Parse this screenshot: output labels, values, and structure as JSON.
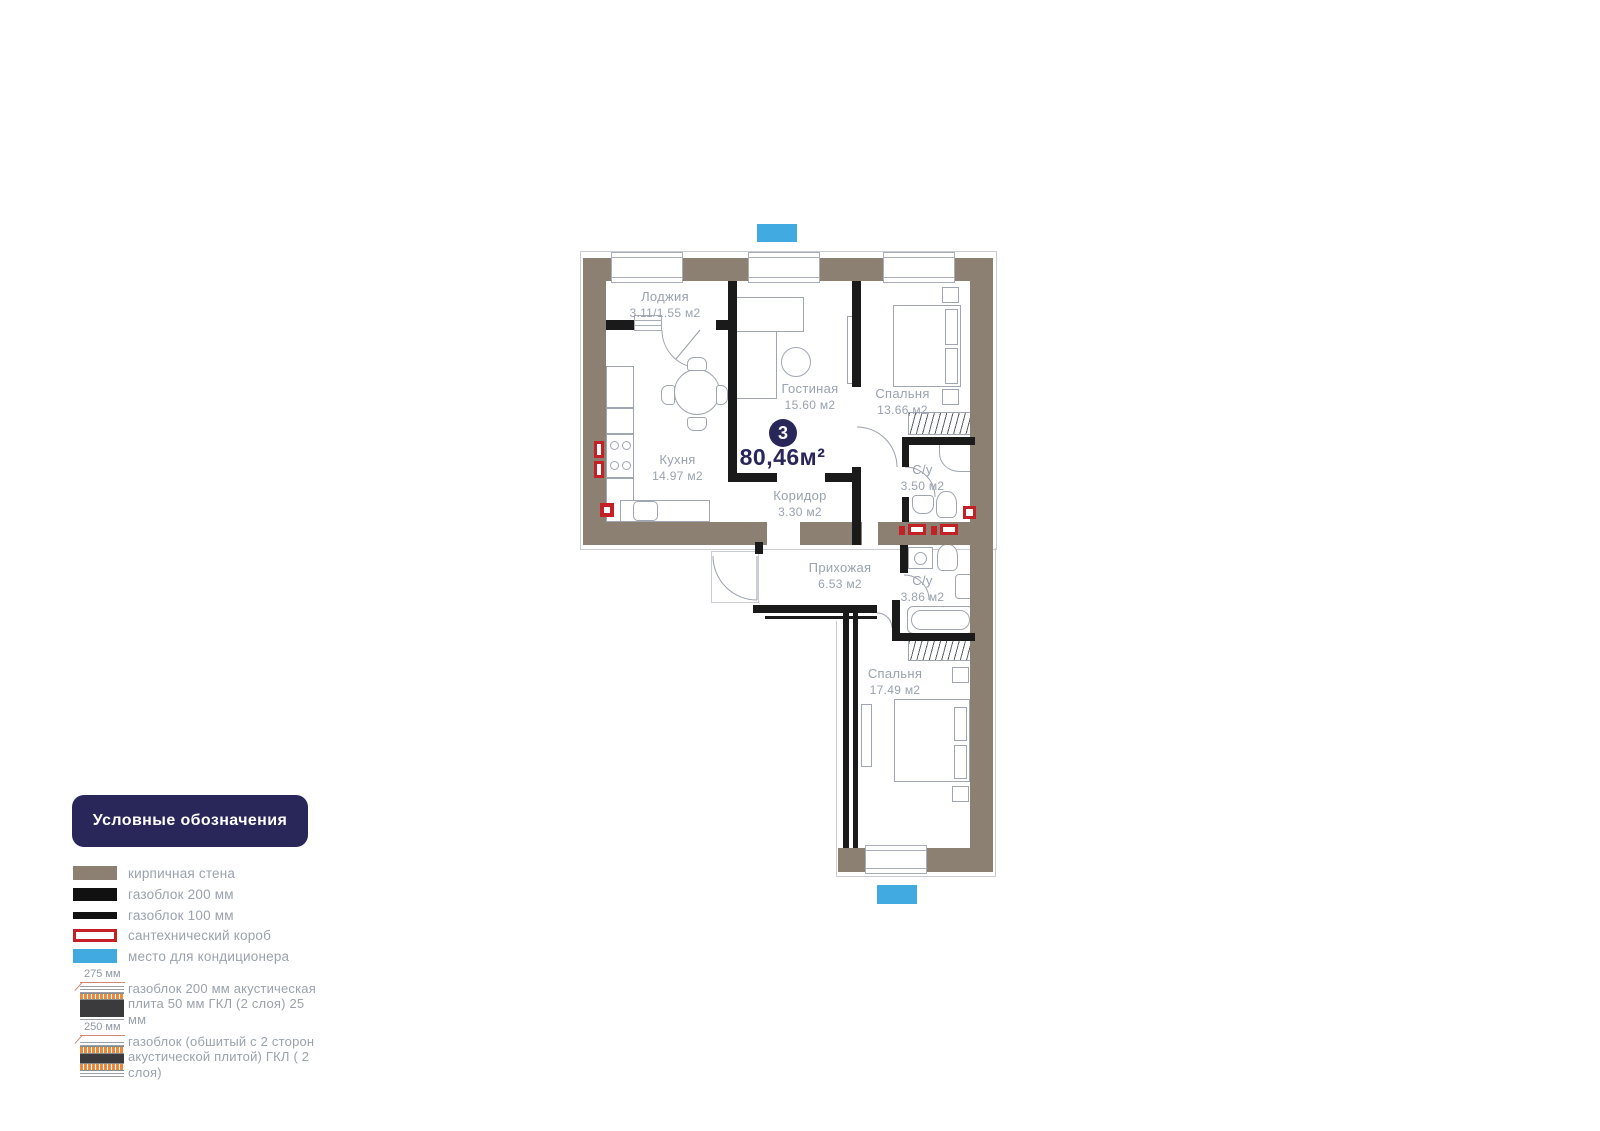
{
  "plan": {
    "badge": "3",
    "total_area": "80,46м²",
    "rooms": [
      {
        "name": "Лоджия",
        "area": "3.11/1.55 м2"
      },
      {
        "name": "Кухня",
        "area": "14.97 м2"
      },
      {
        "name": "Гостиная",
        "area": "15.60 м2"
      },
      {
        "name": "Спальня",
        "area": "13.66 м2"
      },
      {
        "name": "С/у",
        "area": "3.50 м2"
      },
      {
        "name": "Коридор",
        "area": "3.30 м2"
      },
      {
        "name": "Прихожая",
        "area": "6.53 м2"
      },
      {
        "name": "С/у",
        "area": "3.86 м2"
      },
      {
        "name": "Спальня",
        "area": "17.49 м2"
      }
    ]
  },
  "legend": {
    "title": "Условные обозначения",
    "items": [
      {
        "label": "кирпичная стена"
      },
      {
        "label": "газоблок 200 мм"
      },
      {
        "label": "газоблок 100 мм"
      },
      {
        "label": "сантехнический короб"
      },
      {
        "label": "место для кондиционера"
      }
    ],
    "layered": [
      {
        "dim": "275 мм",
        "label": "газоблок 200 мм акустическая плита 50 мм ГКЛ (2 слоя) 25 мм"
      },
      {
        "dim": "250 мм",
        "label": "газоблок (обшитый с 2 сторон акустической плитой) ГКЛ ( 2 слоя)"
      }
    ]
  },
  "colors": {
    "brick_wall": "#8c8072",
    "block_wall": "#1a1a1a",
    "plumbing_red": "#c42126",
    "ac_blue": "#41aae1",
    "navy": "#29265a",
    "label_gray": "#99a2b0"
  }
}
